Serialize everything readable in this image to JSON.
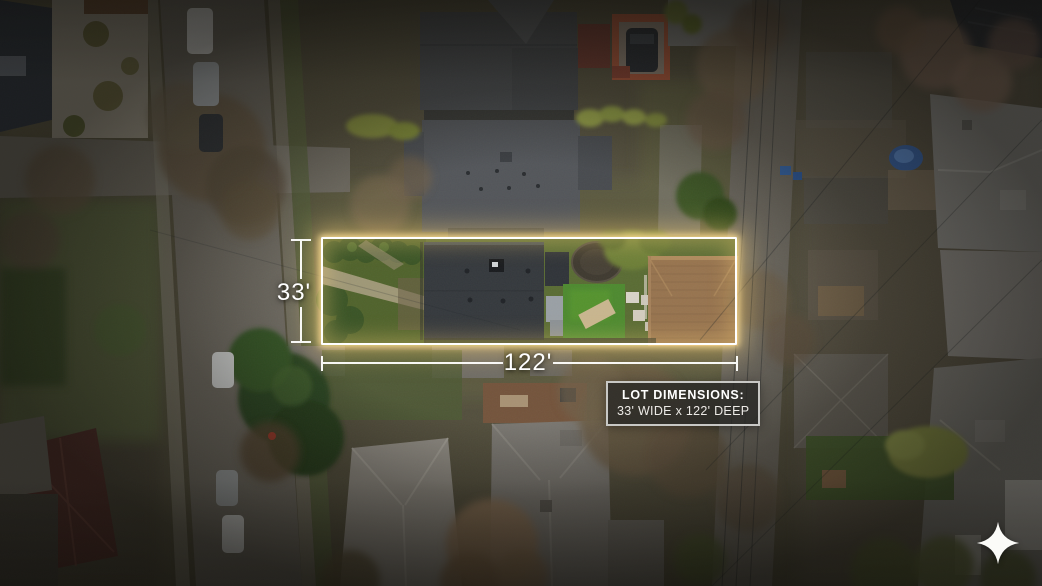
{
  "scene": {
    "description": "Aerial drone photo of a residential neighborhood block with a highlighted property lot"
  },
  "annotations": {
    "width_label": "33'",
    "depth_label": "122'",
    "info_box": {
      "title": "LOT DIMENSIONS:",
      "subtitle": "33' WIDE x 122' DEEP"
    }
  },
  "branding": {
    "logo_icon": "sparkle-icon"
  },
  "colors": {
    "lot_outline": "#ffffff",
    "lot_glow": "#ffd578",
    "dimension_text": "#ffffff",
    "dimension_lines": "#fdfdfb",
    "info_border": "#c8c8c5",
    "info_bg": "rgba(40,40,38,0.80)",
    "logo_fill": "#fbfbf8"
  }
}
